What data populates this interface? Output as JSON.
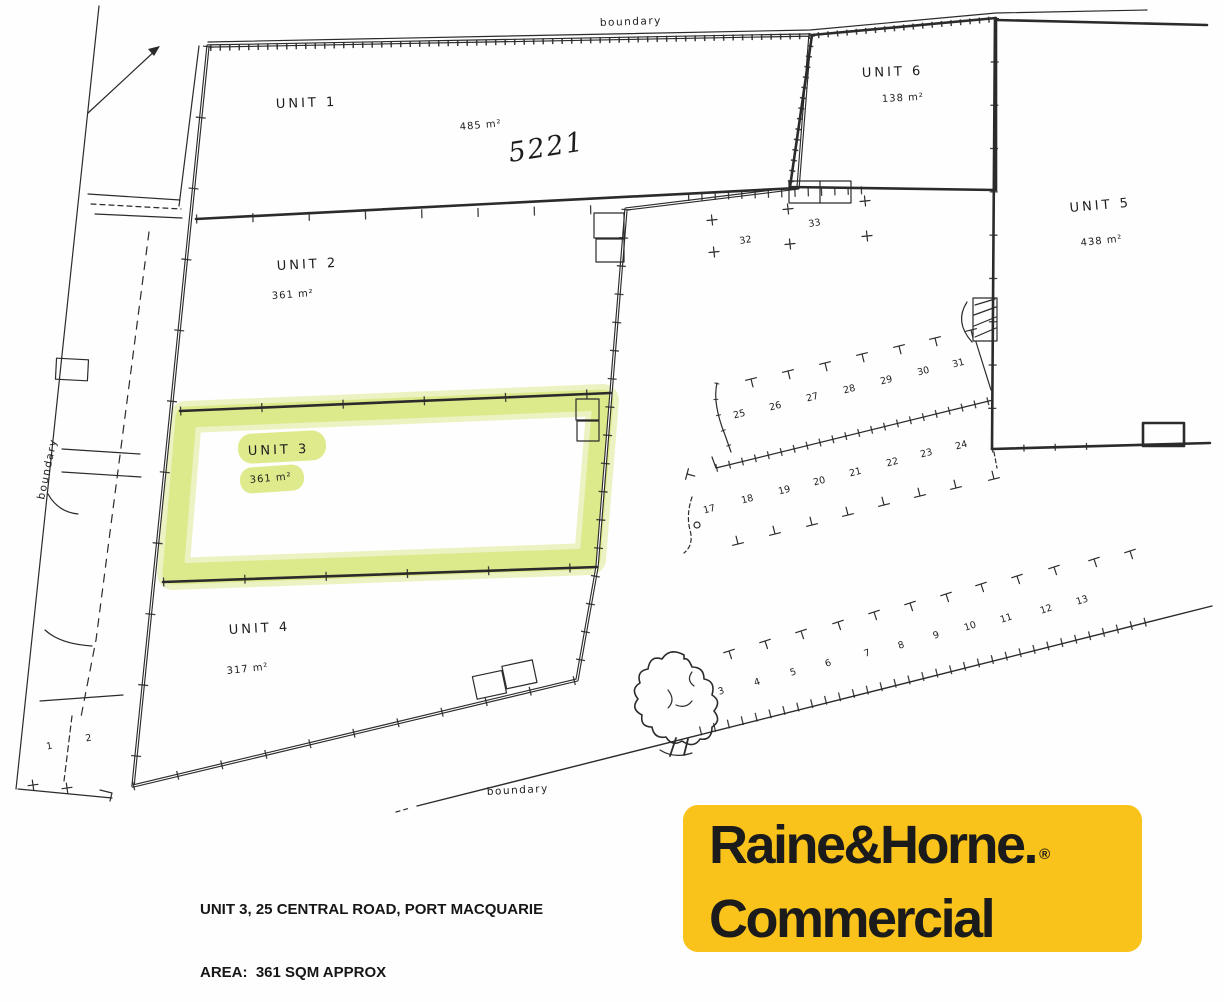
{
  "plan": {
    "boundary_labels": {
      "top": "boundary",
      "left": "boundary",
      "bottom": "boundary"
    },
    "units": [
      {
        "id": 1,
        "label": "UNIT 1",
        "area": "485 m²",
        "note": "5221"
      },
      {
        "id": 2,
        "label": "UNIT 2",
        "area": "361 m²"
      },
      {
        "id": 3,
        "label": "UNIT 3",
        "area": "361 m²",
        "highlighted": true
      },
      {
        "id": 4,
        "label": "UNIT 4",
        "area": "317 m²"
      },
      {
        "id": 5,
        "label": "UNIT 5",
        "area": "438 m²"
      },
      {
        "id": 6,
        "label": "UNIT 6",
        "area": "138 m²"
      }
    ],
    "parking": {
      "yard_spaces": [
        "32",
        "33"
      ],
      "upper_row": [
        "25",
        "26",
        "27",
        "28",
        "29",
        "30",
        "31"
      ],
      "middle_row": [
        "17",
        "18",
        "19",
        "20",
        "21",
        "22",
        "23",
        "24"
      ],
      "boundary_row": [
        "3",
        "4",
        "5",
        "6",
        "7",
        "8",
        "9",
        "10",
        "11",
        "12",
        "13"
      ],
      "road_spaces": [
        "1",
        "2"
      ]
    }
  },
  "caption": {
    "line1": "UNIT 3, 25 CENTRAL ROAD, PORT MACQUARIE",
    "line2": "AREA:  361 SQM APPROX"
  },
  "logo": {
    "brand": "Raine&Horne.",
    "registered": "®",
    "division": "Commercial"
  },
  "colors": {
    "highlight": "#dce985",
    "highlight_soft": "#d8e57b",
    "logo_bg": "#F9C31B",
    "ink": "#2b2b2b"
  }
}
